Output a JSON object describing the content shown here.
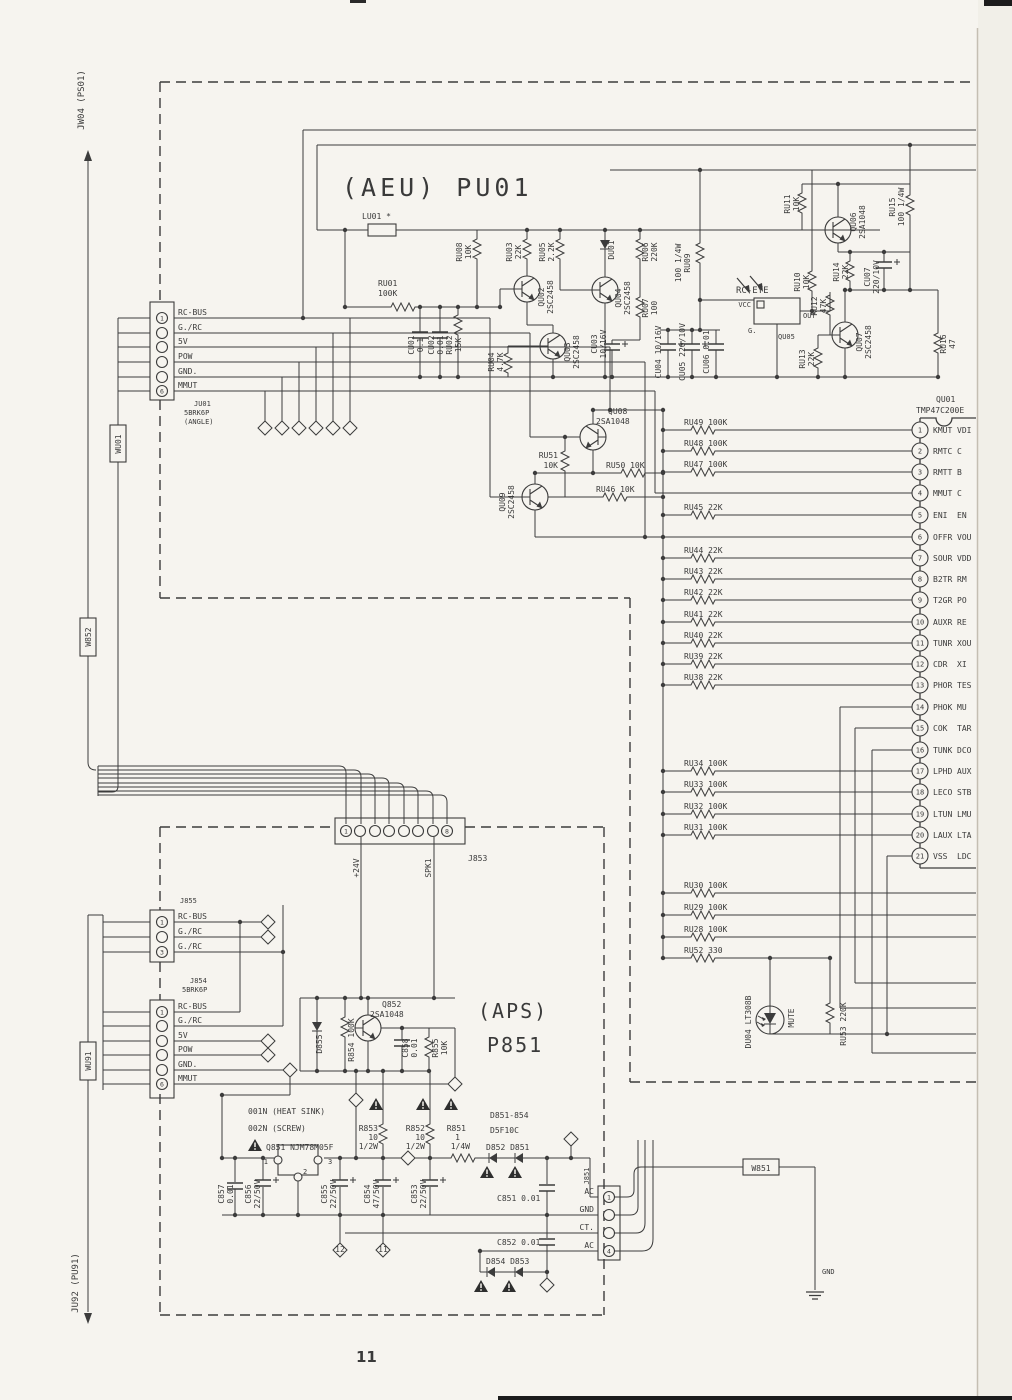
{
  "page": {
    "number": "11"
  },
  "edges": {
    "jw04": "JW04 (PS01)",
    "ju92": "JU92 (PU91)",
    "wu01": "WU01",
    "w852": "W852",
    "wu91": "WU91",
    "w851": "W851",
    "gnd": "GND"
  },
  "aeu": {
    "title": "(AEU) PU01",
    "ju01": {
      "id": "JU01",
      "type": "5BRK6P",
      "note": "(ANGLE)",
      "nums": [
        "1",
        "6"
      ],
      "pins": [
        "RC-BUS",
        "G./RC",
        "5V",
        "POW",
        "GND.",
        "MMUT"
      ]
    },
    "parts": {
      "lu01": "LU01  *",
      "ru01a": "RU01",
      "ru01b": "100K",
      "cu01a": "CU01",
      "cu01b": "0.1",
      "cu02a": "CU02",
      "cu02b": "0.01",
      "ru02a": "RU02",
      "ru02b": "15K",
      "ru08a": "RU08",
      "ru08b": "10K",
      "ru03a": "RU03",
      "ru03b": "22K",
      "ru05a": "RU05",
      "ru05b": "2.2K",
      "qu02a": "QU02",
      "qu02b": "2SC2458",
      "qu03a": "QU03",
      "qu03b": "2SC2458",
      "qu04a": "QU04",
      "qu04b": "2SC2458",
      "ru04a": "RU04",
      "ru04b": "4.7K",
      "du01": "DU01",
      "ru06a": "RU06",
      "ru06b": "220K",
      "ru07a": "RU07",
      "ru07b": "100",
      "cu03a": "CU03",
      "cu03b": "10/16V",
      "cu04": "CU04 10/16V",
      "cu05": "CU05 220/10V",
      "cu06": "CU06 0.01",
      "ru09a": "RU09",
      "ru09b": "100 1/4W",
      "rc_eye": "RC-EYE",
      "vcc": "VCC",
      "out": "OUT",
      "g": "G.",
      "qu05": "QU05",
      "ru10a": "RU10",
      "ru10b": "10K",
      "ru11a": "RU11",
      "ru11b": "10K",
      "qu06a": "QU06",
      "qu06b": "2SA1048",
      "ru15a": "RU15",
      "ru15b": "100 1/4W",
      "ru14a": "RU14",
      "ru14b": "22K",
      "cu07a": "CU07",
      "cu07b": "220/10V",
      "ru12a": "RU12",
      "ru12b": "47K",
      "ru13a": "RU13",
      "ru13b": "22K",
      "qu07a": "QU07",
      "qu07b": "2SC2458",
      "ru16a": "RU16",
      "ru16b": "47",
      "qu08a": "QU08",
      "qu08b": "2SA1048",
      "ru51a": "RU51",
      "ru51b": "10K",
      "qu09a": "QU09",
      "qu09b": "2SC2458",
      "ru50": "RU50 10K",
      "ru46": "RU46 10K",
      "du04": "DU04 LT308B",
      "mute": "MUTE",
      "ru53": "RU53 220K"
    },
    "ic": {
      "id": "QU01",
      "part": "TMP47C200E",
      "pins": [
        {
          "n": "1",
          "name": "KMUT",
          "r": "VDI"
        },
        {
          "n": "2",
          "name": "RMTC",
          "r": "C"
        },
        {
          "n": "3",
          "name": "RMTT",
          "r": "B"
        },
        {
          "n": "4",
          "name": "MMUT",
          "r": "C"
        },
        {
          "n": "5",
          "name": "ENI",
          "r": "EN"
        },
        {
          "n": "6",
          "name": "OFFR",
          "r": "VOU"
        },
        {
          "n": "7",
          "name": "SOUR",
          "r": "VDD"
        },
        {
          "n": "8",
          "name": "B2TR",
          "r": "RM"
        },
        {
          "n": "9",
          "name": "T2GR",
          "r": "PO"
        },
        {
          "n": "10",
          "name": "AUXR",
          "r": "RE"
        },
        {
          "n": "11",
          "name": "TUNR",
          "r": "XOU"
        },
        {
          "n": "12",
          "name": "CDR",
          "r": "XI"
        },
        {
          "n": "13",
          "name": "PHOR",
          "r": "TES"
        },
        {
          "n": "14",
          "name": "PHOK",
          "r": "MU"
        },
        {
          "n": "15",
          "name": "COK",
          "r": "TAR"
        },
        {
          "n": "16",
          "name": "TUNK",
          "r": "DCO"
        },
        {
          "n": "17",
          "name": "LPHD",
          "r": "AUX"
        },
        {
          "n": "18",
          "name": "LECO",
          "r": "STB"
        },
        {
          "n": "19",
          "name": "LTUN",
          "r": "LMU"
        },
        {
          "n": "20",
          "name": "LAUX",
          "r": "LTA"
        },
        {
          "n": "21",
          "name": "VSS",
          "r": "LDC"
        }
      ]
    },
    "ladder": [
      "RU49 100K",
      "RU48 100K",
      "RU47 100K",
      "RU45 22K",
      "RU44 22K",
      "RU43 22K",
      "RU42 22K",
      "RU41 22K",
      "RU40 22K",
      "RU39 22K",
      "RU38 22K",
      "RU34 100K",
      "RU33 100K",
      "RU32 100K",
      "RU31 100K",
      "RU30 100K",
      "RU29 100K",
      "RU28 100K",
      "RU52 330"
    ]
  },
  "aps": {
    "title1": "(APS)",
    "title2": "P851",
    "j853": {
      "id": "J853",
      "nums": [
        "1",
        "8"
      ],
      "p24v": "+24V",
      "spk1": "SPK1"
    },
    "j855": {
      "id": "J855",
      "nums": [
        "1",
        "3"
      ],
      "pins": [
        "RC-BUS",
        "G./RC",
        "G./RC"
      ]
    },
    "j854": {
      "id": "J854",
      "type": "5BRK6P",
      "nums": [
        "1",
        "6"
      ],
      "pins": [
        "RC-BUS",
        "G./RC",
        "5V",
        "POW",
        "GND.",
        "MMUT"
      ]
    },
    "j851": {
      "id": "J851",
      "nums": [
        "1",
        "4"
      ],
      "pins": [
        "AC",
        "GND",
        "CT.",
        "AC"
      ]
    },
    "parts": {
      "q852a": "Q852",
      "q852b": "2SA1048",
      "d855": "D855",
      "r854": "R854 100K",
      "c858a": "C858",
      "c858b": "0.01",
      "r855a": "R855",
      "r855b": "10K",
      "note1": "001N (HEAT SINK)",
      "note2": "002N (SCREW)",
      "q851": "Q851 NJM78M05F",
      "q851_p1": "1",
      "q851_p3": "3",
      "q851_p2": "2",
      "r853a": "R853",
      "r853b": "10",
      "r853c": "1/2W",
      "r852a": "R852",
      "r852b": "10",
      "r852c": "1/2W",
      "r851a": "R851",
      "r851b": "1",
      "r851c": "1/4W",
      "dgroup1": "D851-854",
      "dgroup2": "D5F10C",
      "d852_851": "D852  D851",
      "d854_853": "D854  D853",
      "c851": "C851 0.01",
      "c852": "C852 0.01",
      "c857a": "C857",
      "c857b": "0.01",
      "c856a": "C856",
      "c856b": "22/50V",
      "c855a": "C855",
      "c855b": "22/50V",
      "c854a": "C854",
      "c854b": "47/50V",
      "c853a": "C853",
      "c853b": "22/50V",
      "d12": "12",
      "d11": "11"
    }
  }
}
